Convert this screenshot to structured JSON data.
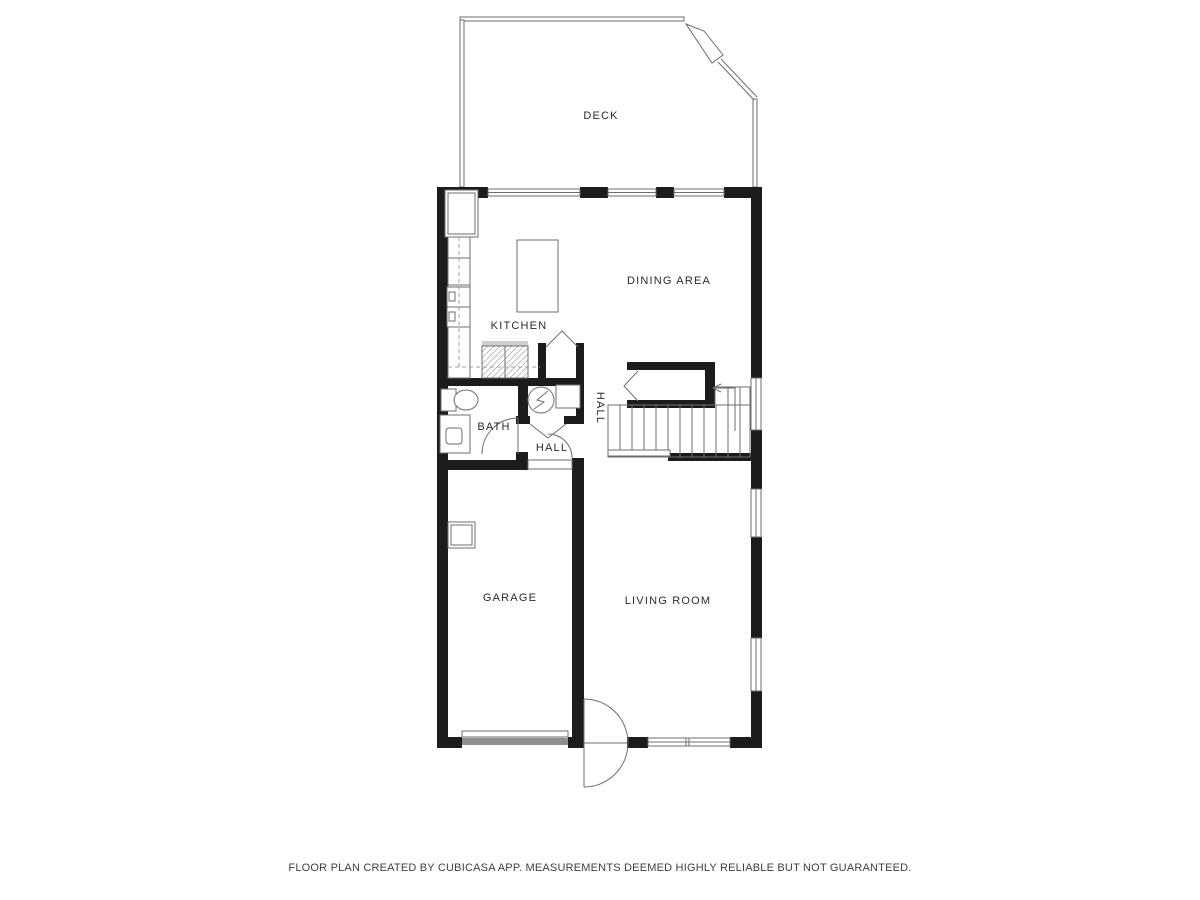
{
  "theme": {
    "bg": "#ffffff",
    "wall": "#1c1c1c",
    "line": "#6e6e6e",
    "line-light": "#a2a2a2",
    "garage-door": "#8f8f8f",
    "hatch": "#cfcfcf",
    "label": "#2b2b2b",
    "footer": "#3f3f3f"
  },
  "labels": {
    "deck": "DECK",
    "dining_area": "DINING AREA",
    "kitchen": "KITCHEN",
    "bath": "BATH",
    "hall": "HALL",
    "hall_vertical": "HALL",
    "garage": "GARAGE",
    "living_room": "LIVING ROOM"
  },
  "footer": {
    "disclaimer": "FLOOR PLAN CREATED BY CUBICASA APP. MEASUREMENTS DEEMED HIGHLY RELIABLE BUT NOT GUARANTEED."
  }
}
